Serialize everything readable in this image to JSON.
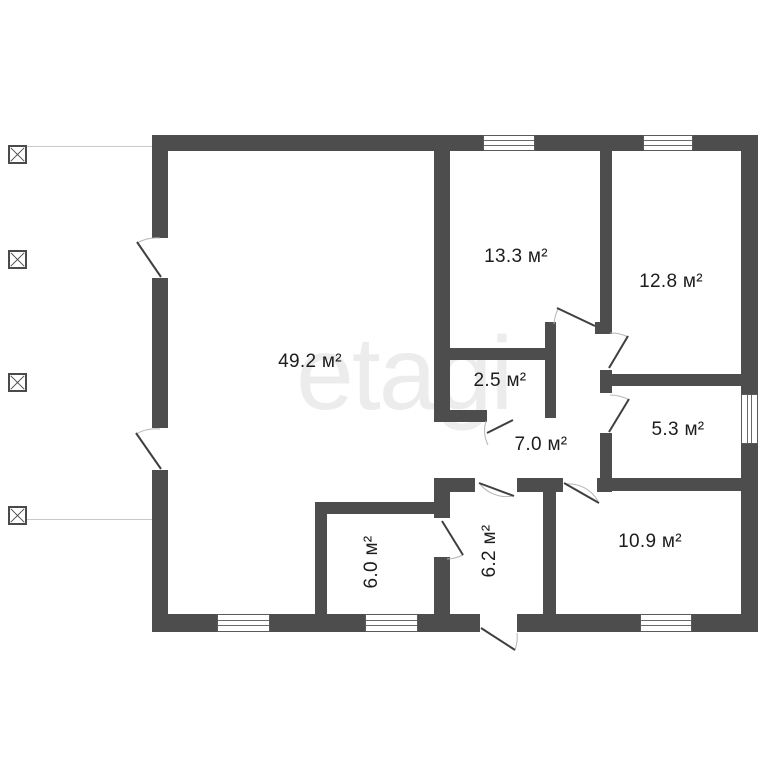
{
  "watermark": "etagi",
  "area_unit": "м²",
  "rooms": [
    {
      "id": "room-49-2",
      "label": "49.2 м²"
    },
    {
      "id": "room-13-3",
      "label": "13.3 м²"
    },
    {
      "id": "room-12-8",
      "label": "12.8 м²"
    },
    {
      "id": "room-2-5",
      "label": "2.5 м²"
    },
    {
      "id": "room-7-0",
      "label": "7.0 м²"
    },
    {
      "id": "room-5-3",
      "label": "5.3 м²"
    },
    {
      "id": "room-6-0",
      "label": "6.0 м²"
    },
    {
      "id": "room-6-2",
      "label": "6.2 м²"
    },
    {
      "id": "room-10-9",
      "label": "10.9 м²"
    }
  ],
  "colors": {
    "wall": "#4d4d4d",
    "label": "#1d1d1d",
    "watermark": "#ececec",
    "window_line": "#6a6a6a",
    "door_leaf": "#3f3f3f",
    "door_arc": "#b5b5b5",
    "porch_line": "#c9c9c9",
    "background": "#ffffff"
  }
}
